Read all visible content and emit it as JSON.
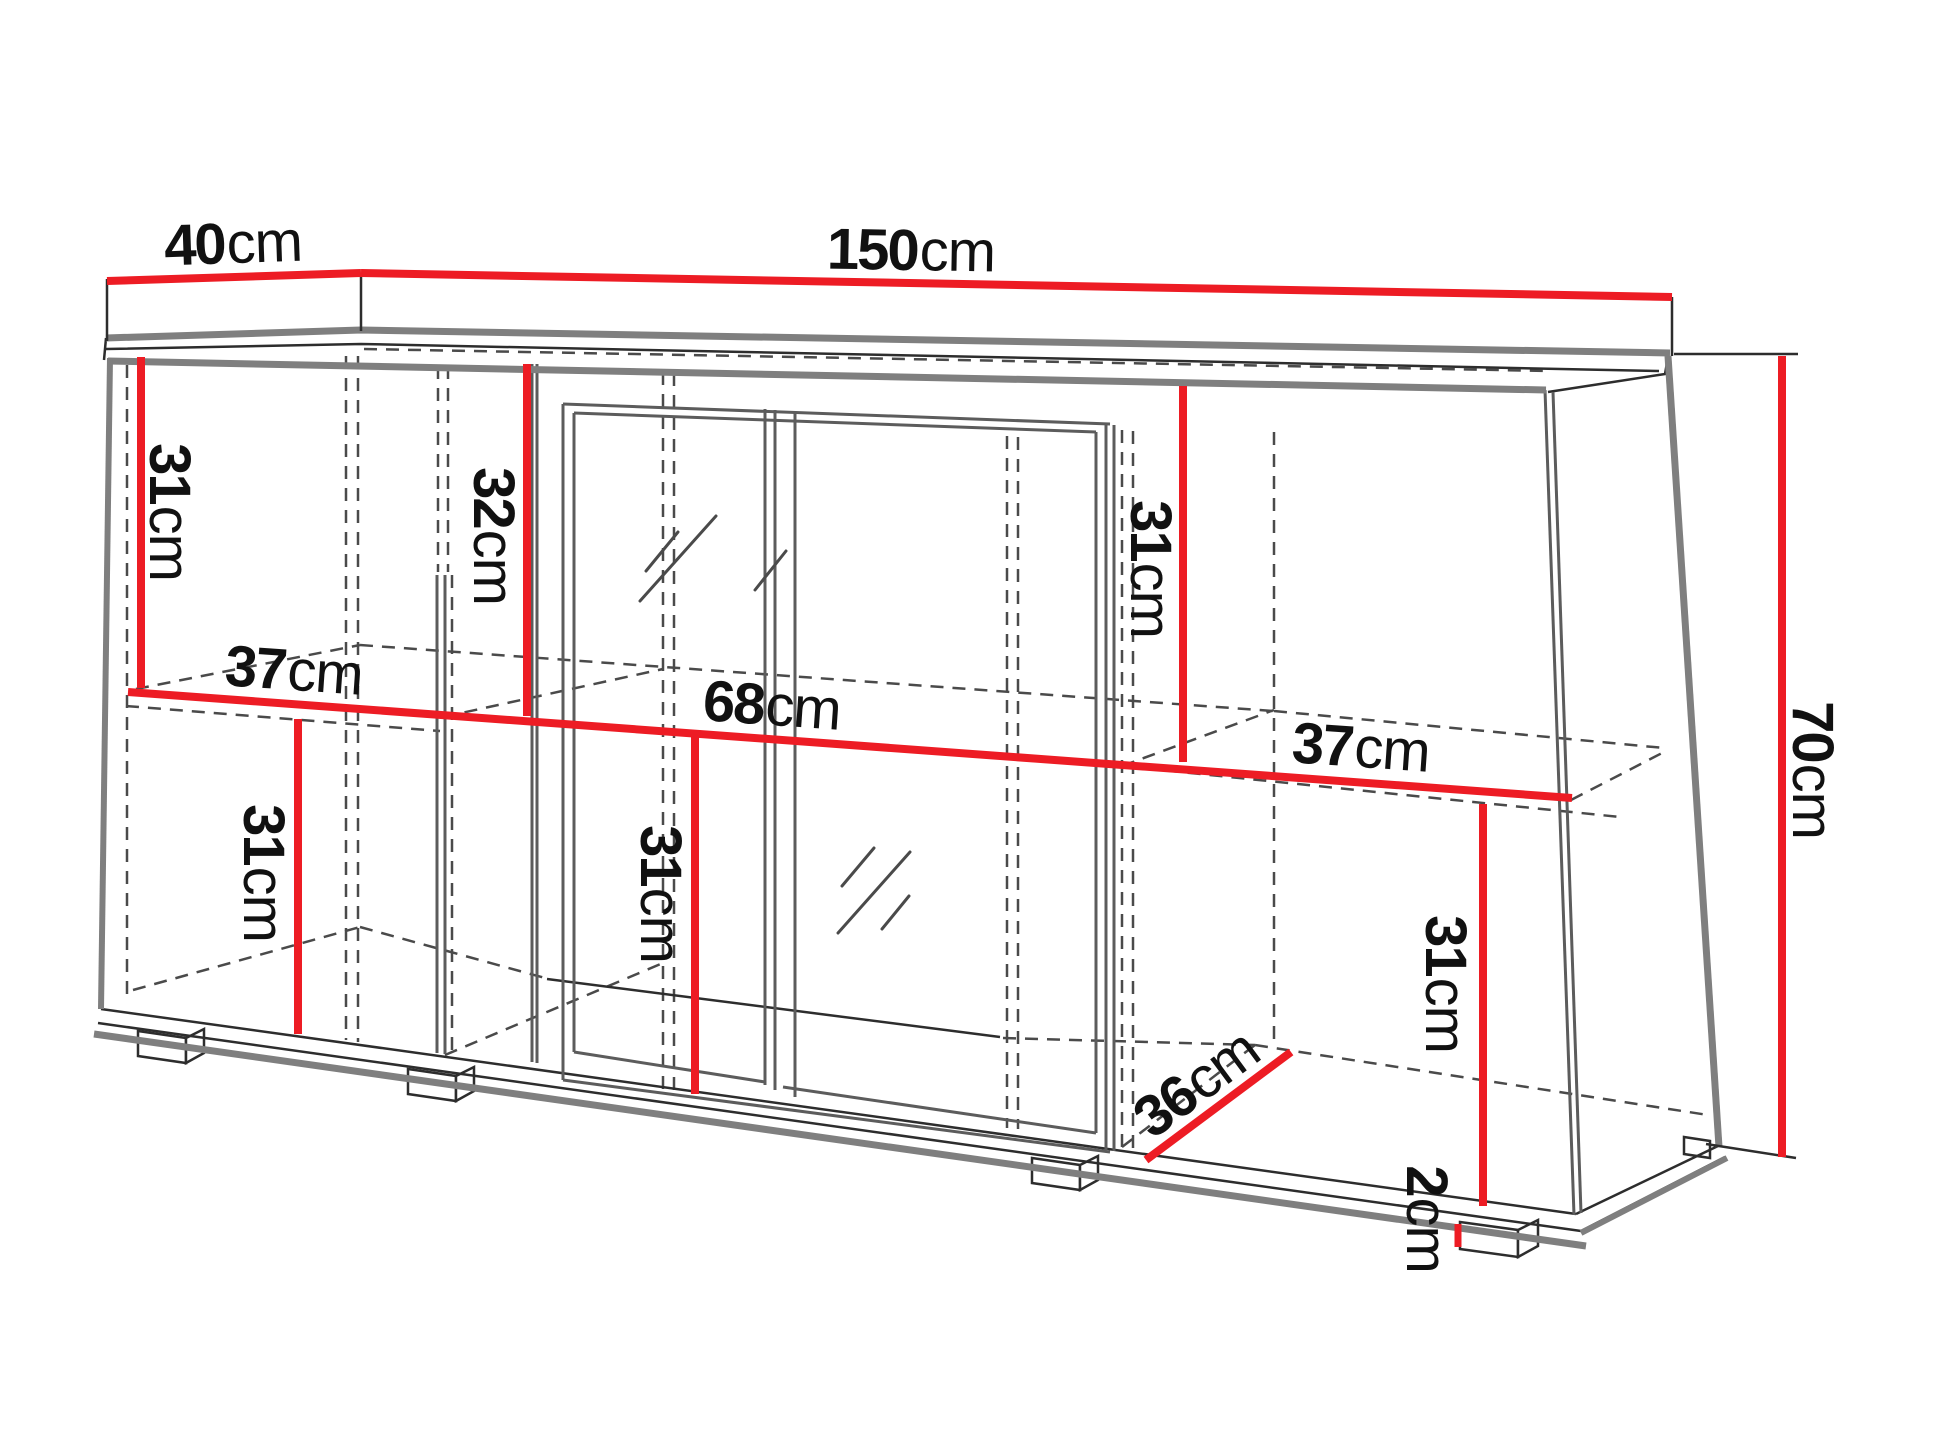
{
  "diagram": {
    "type": "furniture-dimension-drawing",
    "subject": "sideboard-cabinet"
  },
  "colors": {
    "dimension_red": "#ed1c24",
    "edge_dark": "#2d2d2d",
    "edge_gray": "#7f7f7f",
    "panel_gray": "#5c5c5c",
    "label_text": "#111111",
    "background": "#ffffff"
  },
  "dimensions": {
    "depth": {
      "value": "40",
      "unit": "cm"
    },
    "width": {
      "value": "150",
      "unit": "cm"
    },
    "height": {
      "value": "70",
      "unit": "cm"
    },
    "upper_left": {
      "value": "31",
      "unit": "cm"
    },
    "upper_middle": {
      "value": "32",
      "unit": "cm"
    },
    "upper_right": {
      "value": "31",
      "unit": "cm"
    },
    "shelf_left": {
      "value": "37",
      "unit": "cm"
    },
    "shelf_middle": {
      "value": "68",
      "unit": "cm"
    },
    "shelf_right": {
      "value": "37",
      "unit": "cm"
    },
    "lower_left": {
      "value": "31",
      "unit": "cm"
    },
    "lower_middle": {
      "value": "31",
      "unit": "cm"
    },
    "lower_right": {
      "value": "31",
      "unit": "cm"
    },
    "interior_depth": {
      "value": "36",
      "unit": "cm"
    },
    "plinth": {
      "value": "2",
      "unit": "cm"
    }
  }
}
